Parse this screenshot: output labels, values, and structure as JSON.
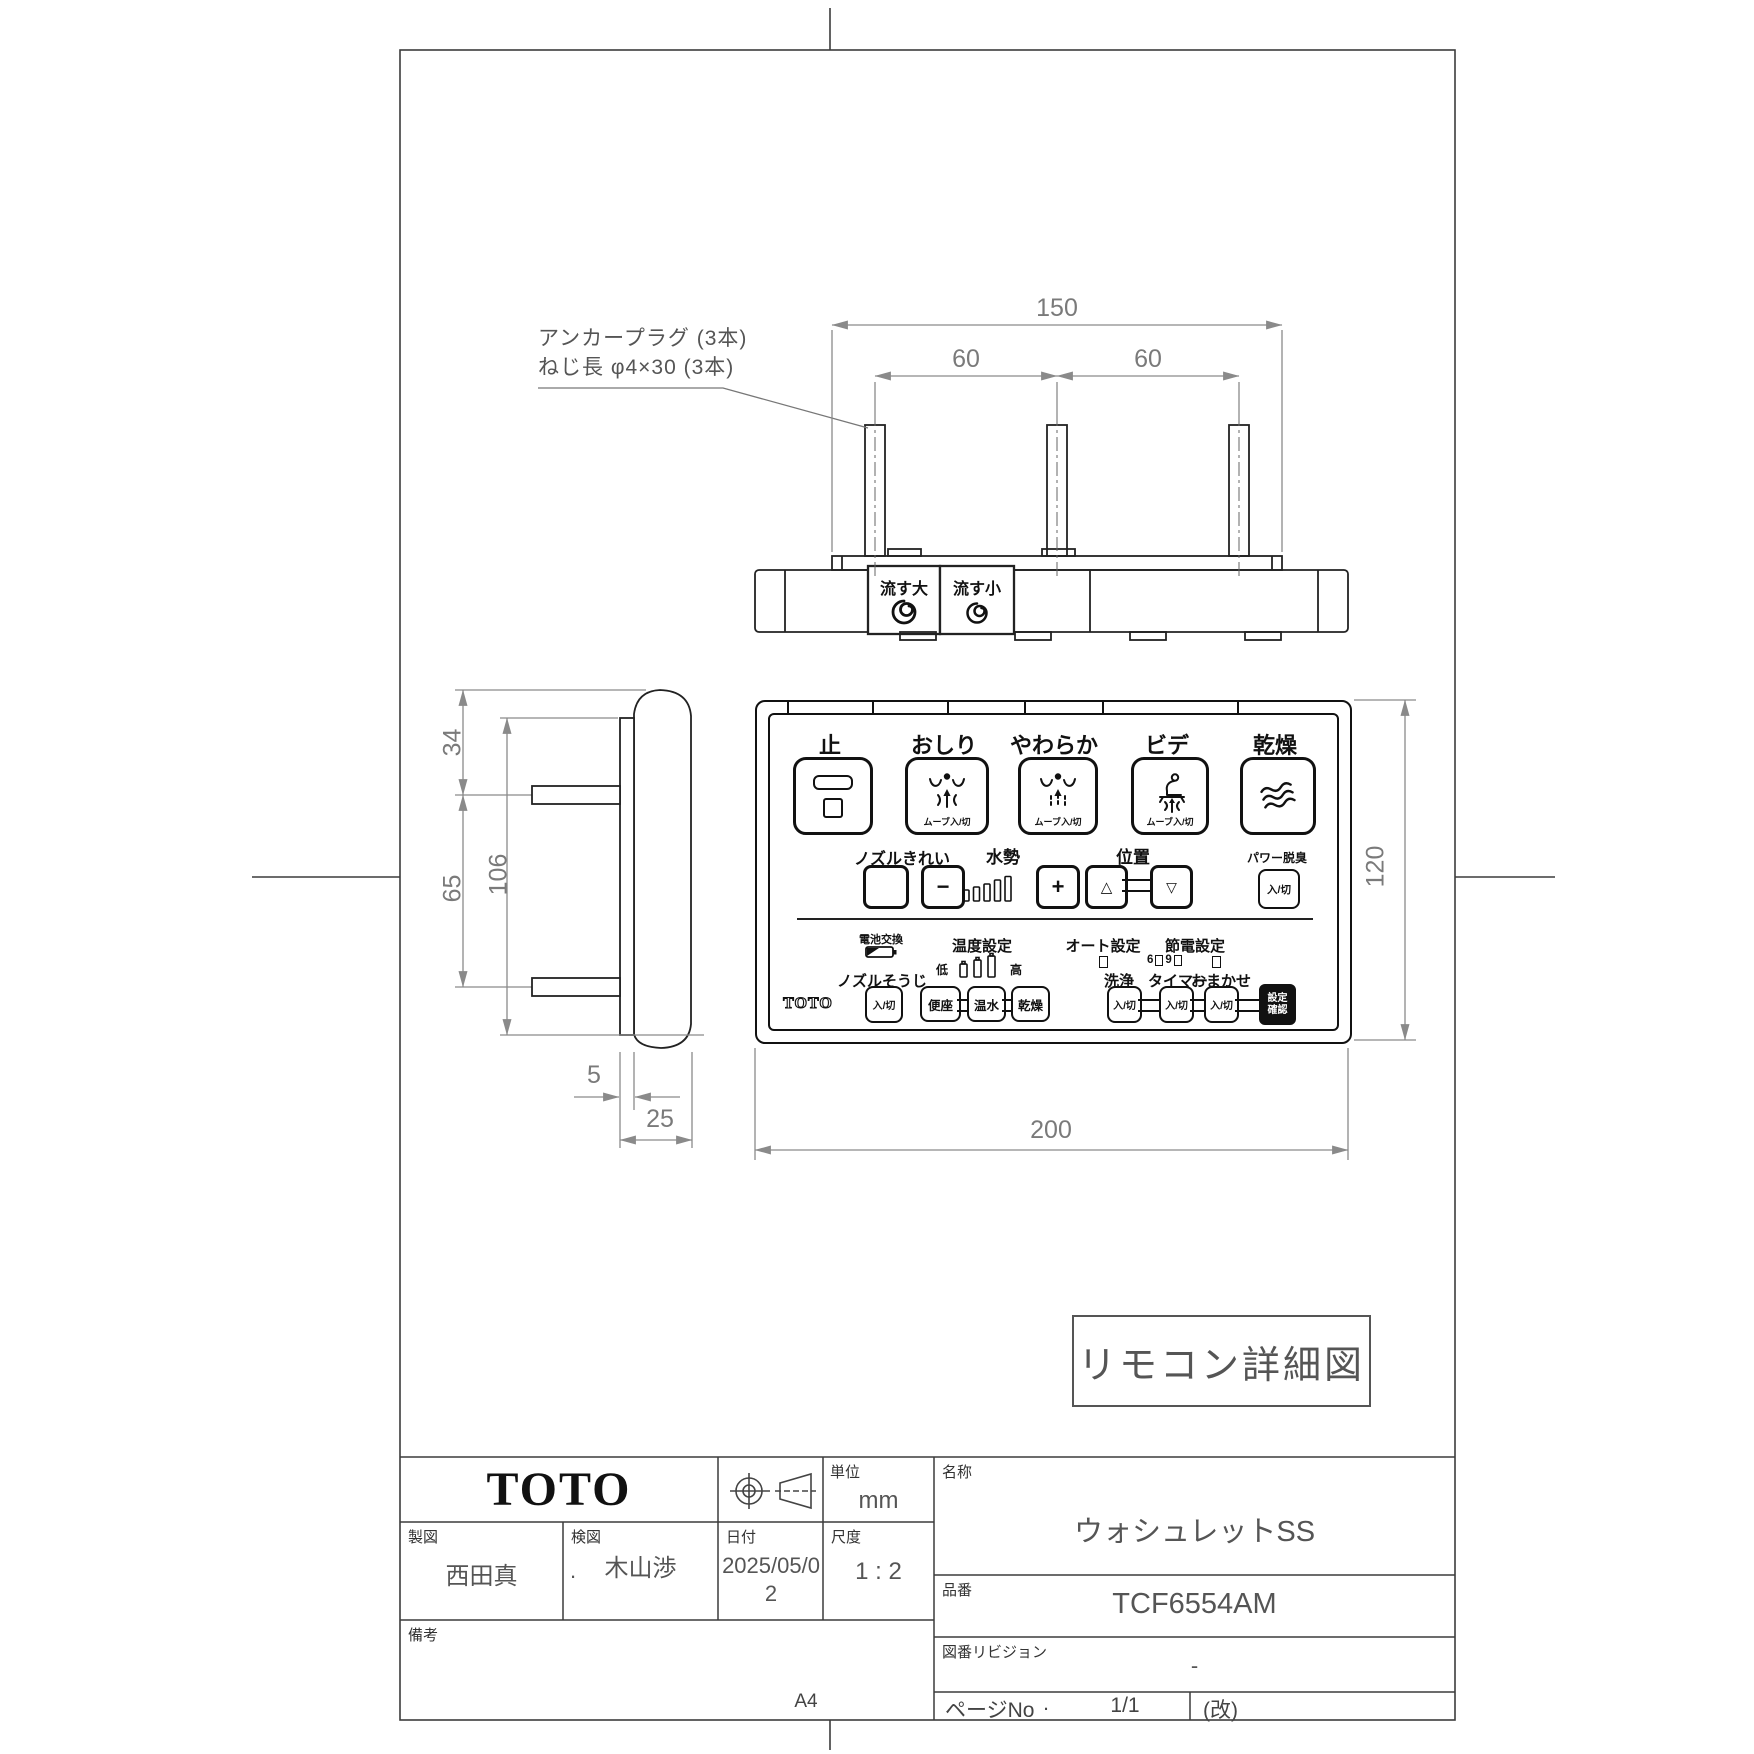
{
  "drawing": {
    "annotation_line1": "アンカープラグ (3本)",
    "annotation_line2": "ねじ長 φ4×30 (3本)",
    "stamp": "リモコン詳細図",
    "paper_size": "A4",
    "dims": {
      "top_width": "150",
      "pitch_left": "60",
      "pitch_right": "60",
      "side_top": "34",
      "side_mid": "65",
      "side_total": "106",
      "plate_thickness": "5",
      "depth_total": "25",
      "front_width": "200",
      "front_height": "120"
    }
  },
  "top_view": {
    "flush_big": "流す大",
    "flush_small": "流す小"
  },
  "remote": {
    "row1": {
      "stop": "止",
      "oshiri": "おしり",
      "yawaraka": "やわらか",
      "bide": "ビデ",
      "kanso": "乾燥",
      "move": "ムーブ入/切"
    },
    "row2": {
      "nozzle_clean": "ノズルきれい",
      "water": "水勢",
      "minus": "−",
      "plus": "+",
      "position": "位置",
      "up": "△",
      "down": "▽",
      "deodorize": "パワー脱臭",
      "onoff": "入/切"
    },
    "row3": {
      "battery": "電池交換",
      "temp": "温度設定",
      "low": "低",
      "high": "高",
      "auto": "オート設定",
      "eco": "節電設定",
      "six": "6",
      "nine": "9",
      "nozzle_wash": "ノズルそうじ",
      "wash": "洗浄",
      "timer": "タイマー",
      "omakase": "おまかせ",
      "onoff": "入/切",
      "seat": "便座",
      "warm": "温水",
      "dry": "乾燥",
      "confirm1": "設定",
      "confirm2": "確認",
      "logo": "TOTO"
    }
  },
  "title_block": {
    "logo": "TOTO",
    "unit_label": "単位",
    "unit_value": "mm",
    "drafter_label": "製図",
    "drafter": "西田真",
    "checker_label": "検図",
    "checker": "木山渉",
    "checker_dot": ".",
    "date_label": "日付",
    "date": "2025/05/02",
    "scale_label": "尺度",
    "scale": "1 : 2",
    "notes_label": "備考",
    "name_label": "名称",
    "name": "ウォシュレットSS",
    "part_label": "品番",
    "part_no": "TCF6554AM",
    "rev_label": "図番リビジョン",
    "rev": "-",
    "page_label": "ページNo",
    "page_dot": ".",
    "page": "1/1",
    "kai": "(改)"
  },
  "colors": {
    "part_line": "#222222",
    "dim_line": "#8a8a8a",
    "frame": "#3c3c3c"
  }
}
